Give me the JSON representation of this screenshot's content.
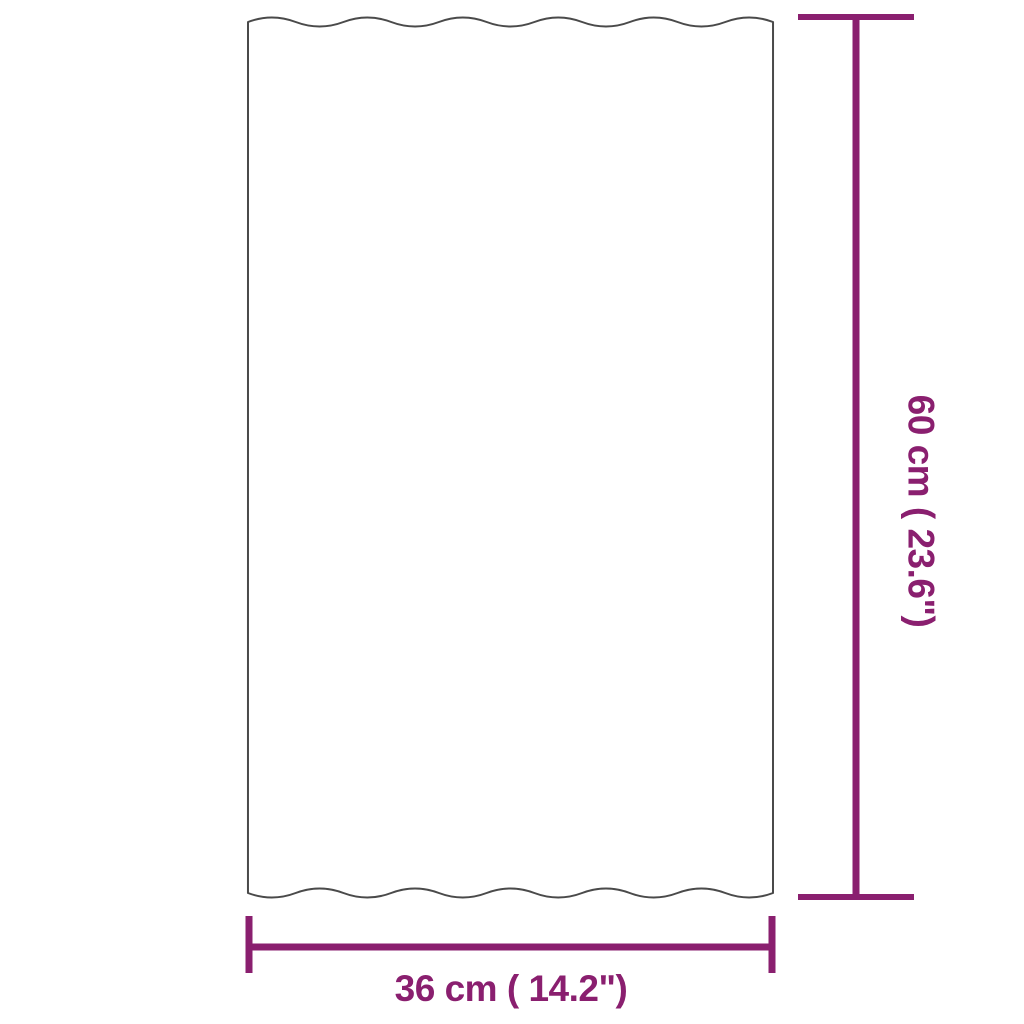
{
  "image_type": "product dimension diagram",
  "panel": {
    "name": "corrugated roof panel outline",
    "fill": "#ffffff",
    "outline_color": "#4a4a4a"
  },
  "dimensions": {
    "color": "#8a1f6f",
    "height": {
      "label": "60 cm ( 23.6\")"
    },
    "width": {
      "label": "36 cm ( 14.2\")"
    }
  }
}
